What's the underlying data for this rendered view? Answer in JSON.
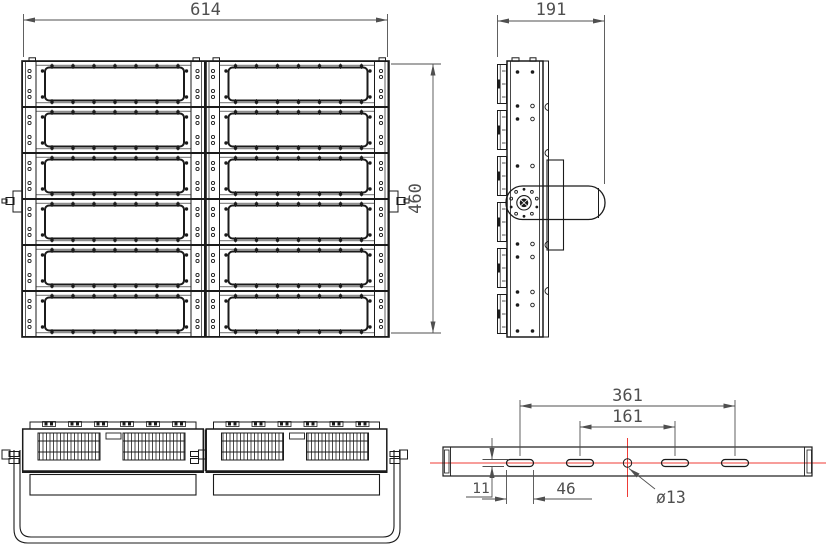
{
  "colors": {
    "background": "#ffffff",
    "drawing_line": "#1b1b1b",
    "dimension": "#4f4f4f",
    "centerline": "#ef3b36"
  },
  "dimensions": {
    "front_width": "614",
    "front_height": "460",
    "side_depth": "191",
    "bracket_outer_slot_spacing": "361",
    "bracket_inner_slot_spacing": "161",
    "bracket_slot_length": "46",
    "bracket_slot_width": "11",
    "bracket_center_hole_diameter": "ø13"
  }
}
